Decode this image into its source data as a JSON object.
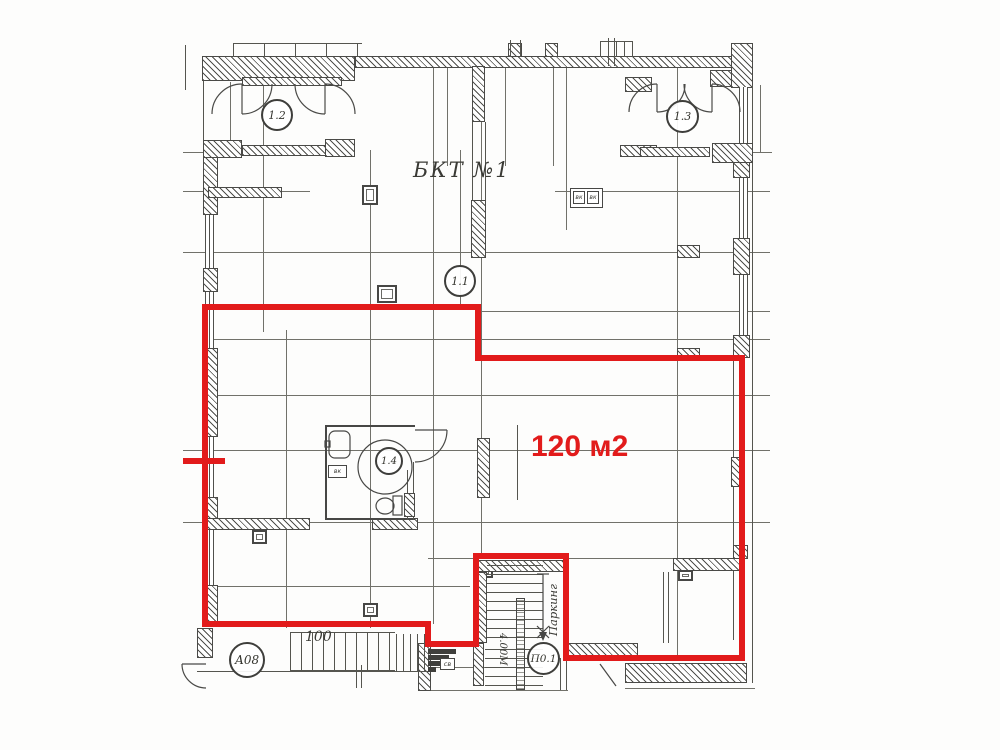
{
  "colors": {
    "accent_red": "#e21b1b",
    "line": "#4a4a47",
    "text": "#3a3a35"
  },
  "labels": {
    "building": "БКТ №1",
    "area": "120 м2",
    "room_1_2": "1.2",
    "room_1_3": "1.3",
    "room_1_1": "1.1",
    "room_1_4": "1.4",
    "mark_a08": "А08",
    "mark_p01": "П0.1",
    "parking": "Паркинг",
    "stair_dim": "4.00М",
    "dim_100": "100",
    "sv": "св",
    "vk_left": "вк",
    "vk_right": "вк",
    "vk_bath": "вк"
  }
}
